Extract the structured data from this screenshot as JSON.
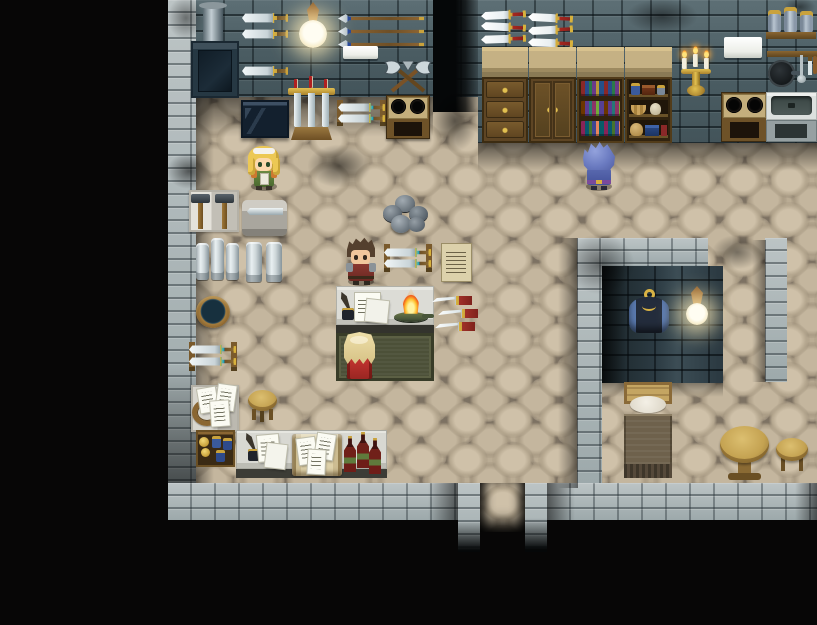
{
  "meta": {
    "genre": "top-down RPG interior scene",
    "location_label": "Blacksmith workshop and living quarters"
  },
  "palette": {
    "void": "#070606",
    "floor_stone": "#b5a78f",
    "wall_dark_brick": "#4a5c62",
    "wall_light_stone": "#aeb6b7",
    "wood": "#6e5228",
    "counter_top": "#e0e0da",
    "fire_orange": "#ff9a26",
    "lamp_glow": "#fff3d0",
    "mat_green": "#4c5038",
    "bottle_red": "#702019"
  },
  "characters": {
    "girl": {
      "label": "Blonde girl with white headband, green dress"
    },
    "smith": {
      "label": "Blacksmith with brown hair and red work clothes"
    },
    "visitor": {
      "label": "Blue-haired visitor in blue coat"
    },
    "clerk": {
      "label": "Long-haired clerk in red robe at the counter"
    }
  },
  "objects": {
    "furnace": {
      "label": "Iron furnace with chimney"
    },
    "wall_swords": {
      "label": "Swords mounted on wall"
    },
    "wall_lamp": {
      "label": "Glowing wall lamp"
    },
    "spears": {
      "label": "Spears mounted on wall"
    },
    "sign_a": {
      "label": "Blank wall plaque"
    },
    "axes": {
      "label": "Crossed battle axes"
    },
    "display_case": {
      "label": "Dark display case"
    },
    "sword_stand": {
      "label": "Sword stand with candles"
    },
    "sword_rack_a": {
      "label": "Rack with two swords"
    },
    "forge_stove": {
      "label": "Forge stove with two burners"
    },
    "hammers": {
      "label": "Smithing hammers on mat"
    },
    "work_slab": {
      "label": "Stone slab with blade"
    },
    "ingots_a": {
      "label": "Stacked metal ingots"
    },
    "ingots_b": {
      "label": "Stacked metal ingots"
    },
    "bucket": {
      "label": "Quenching bucket"
    },
    "ore_pile": {
      "label": "Pile of ore stones"
    },
    "sword_rack_b": {
      "label": "Rack with two swords"
    },
    "wall_notice": {
      "label": "Posted notice"
    },
    "work_counter": {
      "label": "Work counter with ledger, quill and oil flame"
    },
    "wall_knives": {
      "label": "Throwing knives on wall"
    },
    "green_mat": {
      "label": "Green service mat"
    },
    "sword_rack_c": {
      "label": "Rack with two swords"
    },
    "paper_mat": {
      "label": "Documents and rope coil"
    },
    "stool_a": {
      "label": "Wooden stool"
    },
    "supply_crate": {
      "label": "Crate with jars and goods"
    },
    "service_desk": {
      "label": "Desk with papers, open scroll and wine bottles"
    },
    "cabinet_drawers": {
      "label": "Chest of drawers"
    },
    "cabinet_doors": {
      "label": "Storage cabinet"
    },
    "bookshelf": {
      "label": "Bookshelf full of books"
    },
    "curio_shelf": {
      "label": "Shelf with jars, baskets and chests"
    },
    "daggers": {
      "label": "Daggers mounted on wall"
    },
    "candelabra": {
      "label": "Gold candelabra with three candles"
    },
    "sign_b": {
      "label": "Blank kitchen plaque"
    },
    "spice_shelf": {
      "label": "Shelf with three jars"
    },
    "utensil_rack": {
      "label": "Hanging pan and utensils"
    },
    "kitchen_stove": {
      "label": "Kitchen stove"
    },
    "kitchen_sink": {
      "label": "Kitchen sink"
    },
    "coat": {
      "label": "Blue coat on a hook"
    },
    "room_lamp": {
      "label": "Bedroom wall lamp"
    },
    "bed": {
      "label": "Bed with pillow and blanket"
    },
    "round_table": {
      "label": "Round wooden table"
    },
    "stool_b": {
      "label": "Wooden stool"
    },
    "exit": {
      "label": "Doorway passage to the south"
    }
  }
}
